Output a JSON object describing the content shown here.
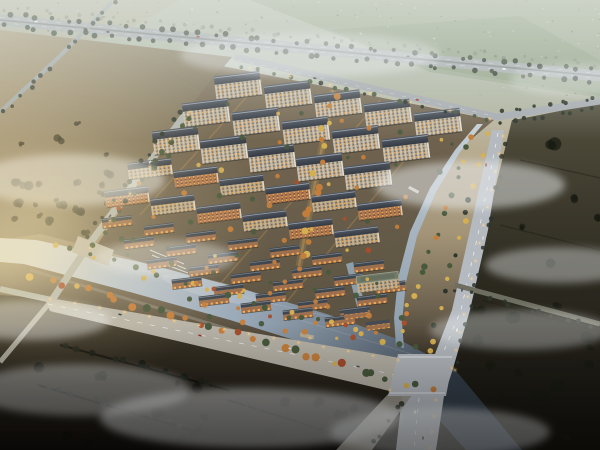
{
  "meta": {
    "type": "architectural-aerial-rendering",
    "description": "Dusk aerial rendering of a master-planned residential community: rows of mid-rise apartment slabs and brick townhouses around a warmly lit central landscape axis, bounded by a tree-lined highway to the north, a canal and arterial boulevard to the east, a widening river with landscaped waterfront promenade to the south-west, hazy farmland and villages in the distance, and dark fields with mist in the foreground."
  },
  "palette": {
    "skyTop": "#c9cfc5",
    "fieldGreen": "#93a287",
    "fieldFar": "#aab3a1",
    "roadLight": "#b4bac0",
    "roadMid": "#a6acb1",
    "roadDark": "#8e9499",
    "treeDark": "#2c352b",
    "treeDeep": "#171c14",
    "treeGreen": "#49593c",
    "treeYellow": "#d4af52",
    "treeOrange": "#c37e3c",
    "treeRed": "#a54f2e",
    "roofDark": "#3a414b",
    "roofLight": "#99a1ab",
    "facade": "#cbc4b5",
    "facadeWarm": "#b07b52",
    "windowLit": "#e8a85c",
    "waterLight": "#d6dce0",
    "waterMid": "#9aa9b8",
    "waterDark": "#46525f",
    "plotLight": "#80715a",
    "plotDark": "#5c5342",
    "pathGlow": "#cf9f55",
    "farmTan": "#ab9b7c",
    "farmDark": "#6b614b",
    "groundDark": "#3a352a",
    "groundBlack": "#14110d",
    "mist": "#eef1f2",
    "glow": "#f6e3ae",
    "lamp": "#ffd892"
  },
  "scene": {
    "counts": {
      "apartment_slabs": 27,
      "townhouses": 29,
      "clubhouse": 1,
      "annex_buildings": 2
    },
    "buildings": {
      "tall_rows": [
        {
          "x": 238,
          "y": 86,
          "n": 5,
          "dx": 50,
          "dy": 9.2
        },
        {
          "x": 206,
          "y": 113,
          "n": 5,
          "dx": 50,
          "dy": 9.0
        },
        {
          "x": 176,
          "y": 141,
          "n": 5,
          "dx": 48,
          "dy": 8.8
        }
      ],
      "mid_rows": [
        {
          "x": 150,
          "y": 169,
          "n": 6,
          "dx": 46,
          "dy": 8.2
        },
        {
          "x": 127,
          "y": 197,
          "n": 6,
          "dx": 46,
          "dy": 8.0
        }
      ],
      "town_rows": [
        {
          "x": 117,
          "y": 222,
          "n": 7,
          "dx": 42,
          "dy": 7.4
        },
        {
          "x": 139,
          "y": 243,
          "n": 7,
          "dx": 42,
          "dy": 7.4
        },
        {
          "x": 162,
          "y": 263,
          "n": 6,
          "dx": 42,
          "dy": 7.4
        },
        {
          "x": 187,
          "y": 283,
          "n": 5,
          "dx": 42,
          "dy": 7.4
        },
        {
          "x": 214,
          "y": 300,
          "n": 4,
          "dx": 42,
          "dy": 7.0
        }
      ],
      "clubhouse": {
        "x": 378,
        "y": 282
      },
      "annex": [
        {
          "x": 356,
          "y": 314
        },
        {
          "x": 378,
          "y": 325
        }
      ]
    }
  }
}
